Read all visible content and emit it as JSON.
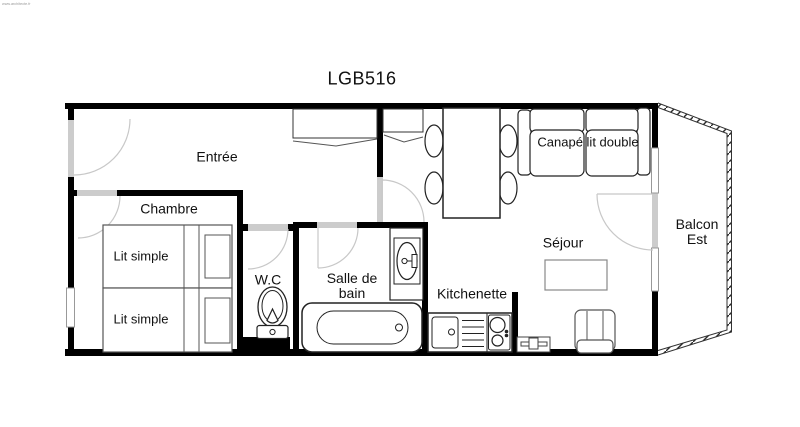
{
  "title": "LGB516",
  "watermark": "www.architecte.fr",
  "rooms": {
    "entree": {
      "label": "Entrée"
    },
    "chambre": {
      "label": "Chambre"
    },
    "wc": {
      "label": "W.C"
    },
    "salle_de_bain": {
      "line1": "Salle de",
      "line2": "bain"
    },
    "kitchenette": {
      "label": "Kitchenette"
    },
    "sejour": {
      "label": "Séjour"
    },
    "balcon_est": {
      "line1": "Balcon",
      "line2": "Est"
    }
  },
  "furniture_labels": {
    "lit_simple_top": "Lit simple",
    "lit_simple_bottom": "Lit simple",
    "canape_lit_double": "Canapé lit double"
  },
  "colors": {
    "background": "#ffffff",
    "wall": "#000000",
    "door_opening": "#cccccc",
    "door_swing_arc": "#c8c8c8",
    "furniture_outline": "#222222",
    "bed_outline": "#555555",
    "light_outline": "#888888",
    "text": "#111111"
  }
}
